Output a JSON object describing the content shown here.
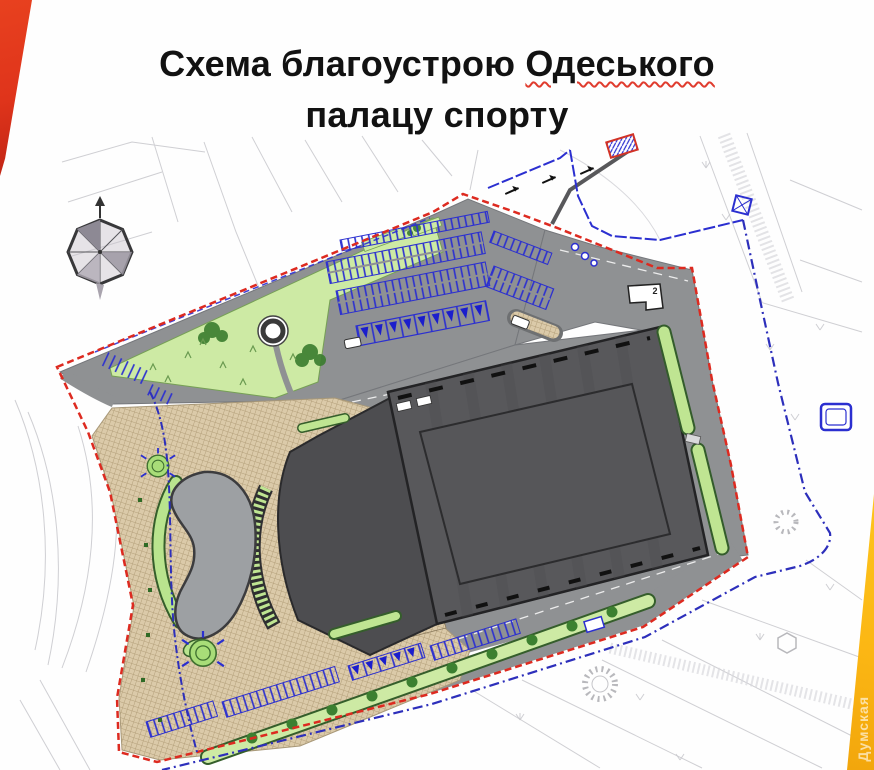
{
  "header": {
    "title_prefix": "Схема благоустрою ",
    "title_highlight": "Одеського",
    "title_line2": "палацу спорту"
  },
  "watermark": {
    "brand": "Думская"
  },
  "plan": {
    "type": "landscaping-site-plan",
    "labels": {
      "service_building": "2"
    }
  },
  "colors": {
    "ribbon_red": "#df341b",
    "ribbon_yellow": "#fcb714",
    "title_text": "#121212",
    "spellcheck_underline": "#e03c2e",
    "boundary_red": "#dd2a20",
    "boundary_blue": "#2d2fbb",
    "parking_blue": "#2b2fd0",
    "road_gray": "#8f9193",
    "building_gray": "#58585b",
    "building_outline": "#232325",
    "annex_gray": "#4d4d50",
    "pond_gray": "#9da0a3",
    "green_light": "#cdeaa4",
    "green_band": "#bfe592",
    "green_dark": "#3c8030",
    "plaza_beige": "#dbcaa9",
    "cadastral_gray": "#c7c7cb"
  }
}
